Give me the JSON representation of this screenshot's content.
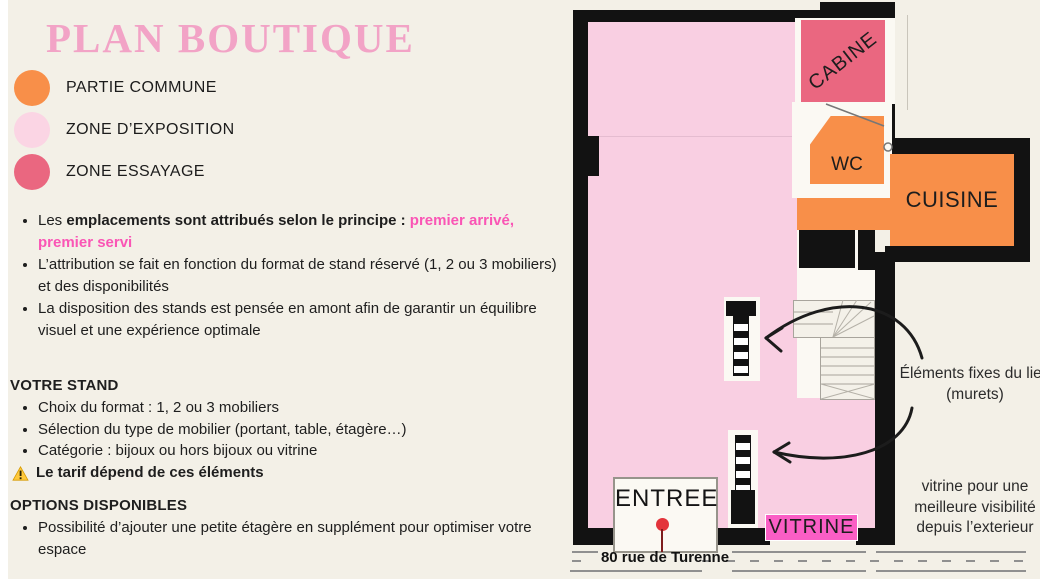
{
  "title": "PLAN BOUTIQUE",
  "colors": {
    "background": "#F3F0E7",
    "title_pink": "#F2A3C6",
    "highlight_pink": "#FA55B5",
    "partie_commune_orange": "#F88F49",
    "zone_exposition_pink": "#FBD5E4",
    "zone_essayage_rose": "#EA6780",
    "plan_pink": "#F9CFE2",
    "vitrine_magenta": "#FA5EC5",
    "wall_black": "#121212",
    "pin_red": "#E3343B"
  },
  "legend": {
    "items": [
      {
        "label": "PARTIE COMMUNE",
        "color": "#F88F49",
        "icon": "circle-swatch"
      },
      {
        "label": "ZONE D’EXPOSITION",
        "color": "#FBD5E4",
        "icon": "circle-swatch"
      },
      {
        "label": "ZONE ESSAYAGE",
        "color": "#EA6780",
        "icon": "circle-swatch"
      }
    ]
  },
  "intro": {
    "bullet1": {
      "prefix": "Les ",
      "bold": "emplacements sont attribués selon le principe : ",
      "highlight": "premier arrivé, premier servi"
    },
    "bullet2": "L’attribution se fait en fonction du format de stand réservé (1, 2 ou 3 mobiliers) et des disponibilités",
    "bullet3": "La disposition des stands est pensée en amont afin de garantir un équilibre visuel et une expérience optimale"
  },
  "votre_stand": {
    "heading": "VOTRE STAND",
    "items": [
      "Choix du format : 1, 2 ou 3 mobiliers",
      "Sélection du type de mobilier (portant, table, étagère…)",
      "Catégorie : bijoux ou hors bijoux ou vitrine"
    ],
    "warning": "Le tarif dépend de ces éléments",
    "warning_icon": "warning-triangle"
  },
  "options": {
    "heading": "OPTIONS DISPONIBLES",
    "items": [
      "Possibilité d’ajouter une petite étagère en supplément pour optimiser votre espace"
    ]
  },
  "plan": {
    "rooms": {
      "cabine": "CABINE",
      "wc": "WC",
      "cuisine": "CUISINE",
      "entree": "ENTREE",
      "vitrine": "VITRINE"
    },
    "street": "80 rue de Turenne",
    "annotations": {
      "murets": "Éléments fixes du lieu (murets)",
      "vitrine_note": "vitrine pour une meilleure visibilité depuis l’exterieur"
    },
    "markers": {
      "entrance_pin": "red-pin"
    }
  }
}
